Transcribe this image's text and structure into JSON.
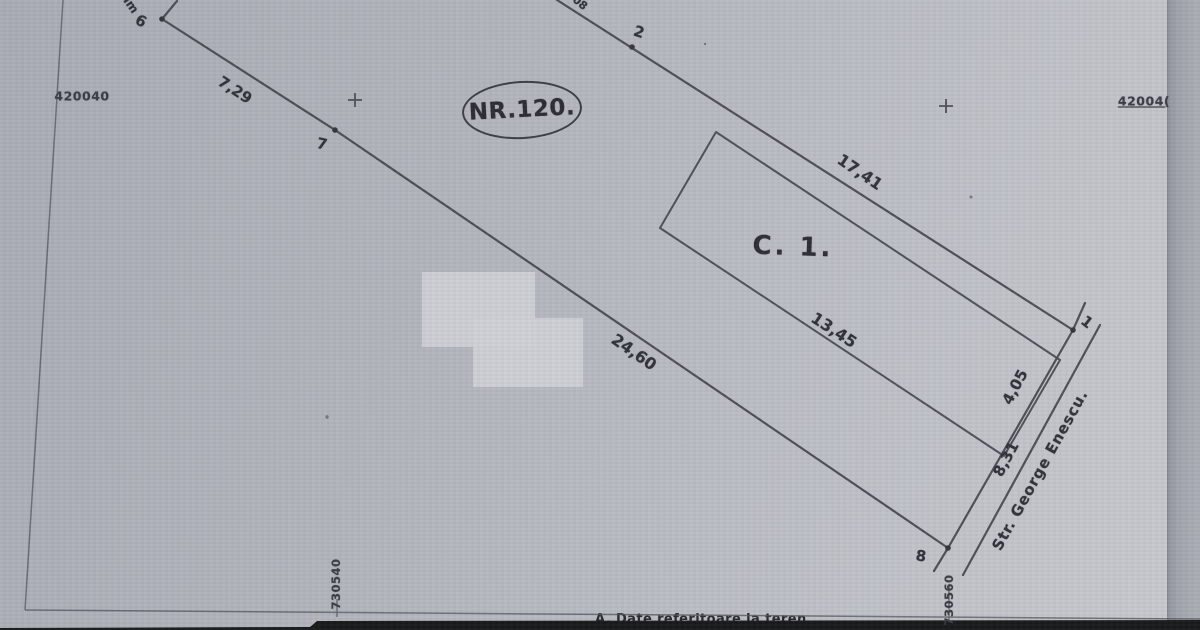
{
  "plan": {
    "parcel_number": "NR.120.",
    "building_label": "C. 1.",
    "street_name": "Str. George Enescu.",
    "edge_text_top_left": "Im",
    "edge_text_top_mid": "08",
    "vertices": {
      "v1": "1",
      "v2": "2",
      "v6": "6",
      "v7": "7",
      "v8": "8"
    },
    "dimensions": {
      "seg_6_7": "7,29",
      "seg_7_8": "24,60",
      "seg_2_1": "17,41",
      "building_side": "13,45",
      "seg_1_corner": "4,05",
      "seg_corner_8": "8,31"
    },
    "grid": {
      "north_left": "420040",
      "north_right": "42004(",
      "east_left": "730540",
      "east_right": "730560"
    },
    "footer_section_title": "A. Date referitoare la teren"
  },
  "colors": {
    "ink": "#43454c",
    "paper": "#b4b7be",
    "redaction": "#cdd0d5",
    "footer_bar": "#18191b"
  }
}
